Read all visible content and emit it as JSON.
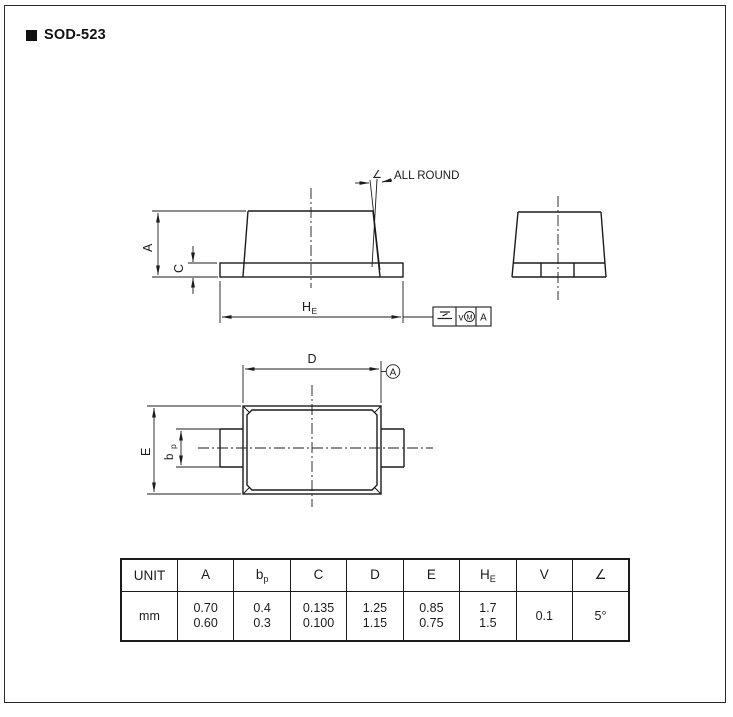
{
  "page": {
    "title": "SOD-523"
  },
  "front_view": {
    "angle_symbol": "∠",
    "all_round_label": "ALL ROUND",
    "dim_a": "A",
    "dim_c": "C",
    "dim_he_main": "H",
    "dim_he_sub": "E"
  },
  "feature_frame": {
    "tolerance": "v",
    "modifier": "M",
    "datum": "A"
  },
  "top_view": {
    "dim_d": "D",
    "dim_e": "E",
    "dim_bp_main": "b",
    "dim_bp_sub": "p",
    "datum_label": "A"
  },
  "table": {
    "unit_header": "UNIT",
    "unit_value": "mm",
    "columns": [
      {
        "sym": "A",
        "sub": "",
        "v1": "0.70",
        "v2": "0.60"
      },
      {
        "sym": "b",
        "sub": "p",
        "v1": "0.4",
        "v2": "0.3"
      },
      {
        "sym": "C",
        "sub": "",
        "v1": "0.135",
        "v2": "0.100"
      },
      {
        "sym": "D",
        "sub": "",
        "v1": "1.25",
        "v2": "1.15"
      },
      {
        "sym": "E",
        "sub": "",
        "v1": "0.85",
        "v2": "0.75"
      },
      {
        "sym": "H",
        "sub": "E",
        "v1": "1.7",
        "v2": "1.5"
      },
      {
        "sym": "V",
        "sub": "",
        "v1": "0.1",
        "v2": ""
      },
      {
        "sym": "∠",
        "sub": "",
        "v1": "5°",
        "v2": ""
      }
    ]
  }
}
